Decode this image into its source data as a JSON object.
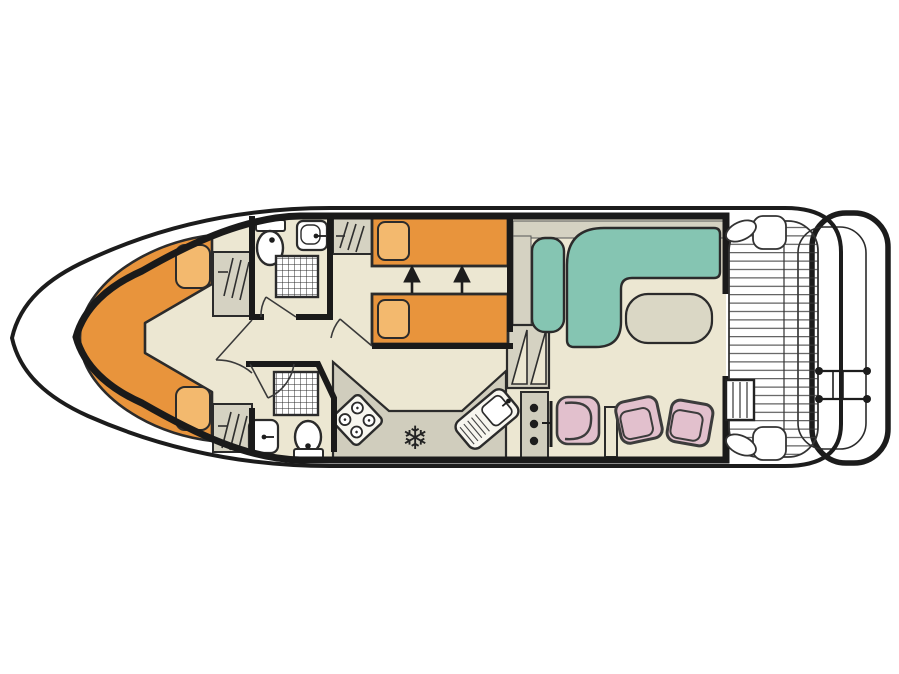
{
  "diagram": {
    "type": "boat-floor-plan",
    "view": "top-down"
  },
  "palette": {
    "background": "#ffffff",
    "hull_line": "#1c1c1c",
    "wall": "#1a1a1a",
    "outline": "#2b2b2b",
    "floor": "#ece7d2",
    "furniture_gray": "#d5d2c2",
    "counter_gray": "#d0cdbd",
    "bed_orange": "#e8943c",
    "pillow_orange": "#f3b96e",
    "sofa_teal": "#85c5b2",
    "chair_pink": "#e2c0cd",
    "table_gray": "#dad7c5",
    "fixture_white": "#ffffff",
    "appliance_white": "#f7f6ef",
    "deck_line": "#3a3a3a"
  },
  "icons": {
    "fridge_snowflake": "❄"
  }
}
